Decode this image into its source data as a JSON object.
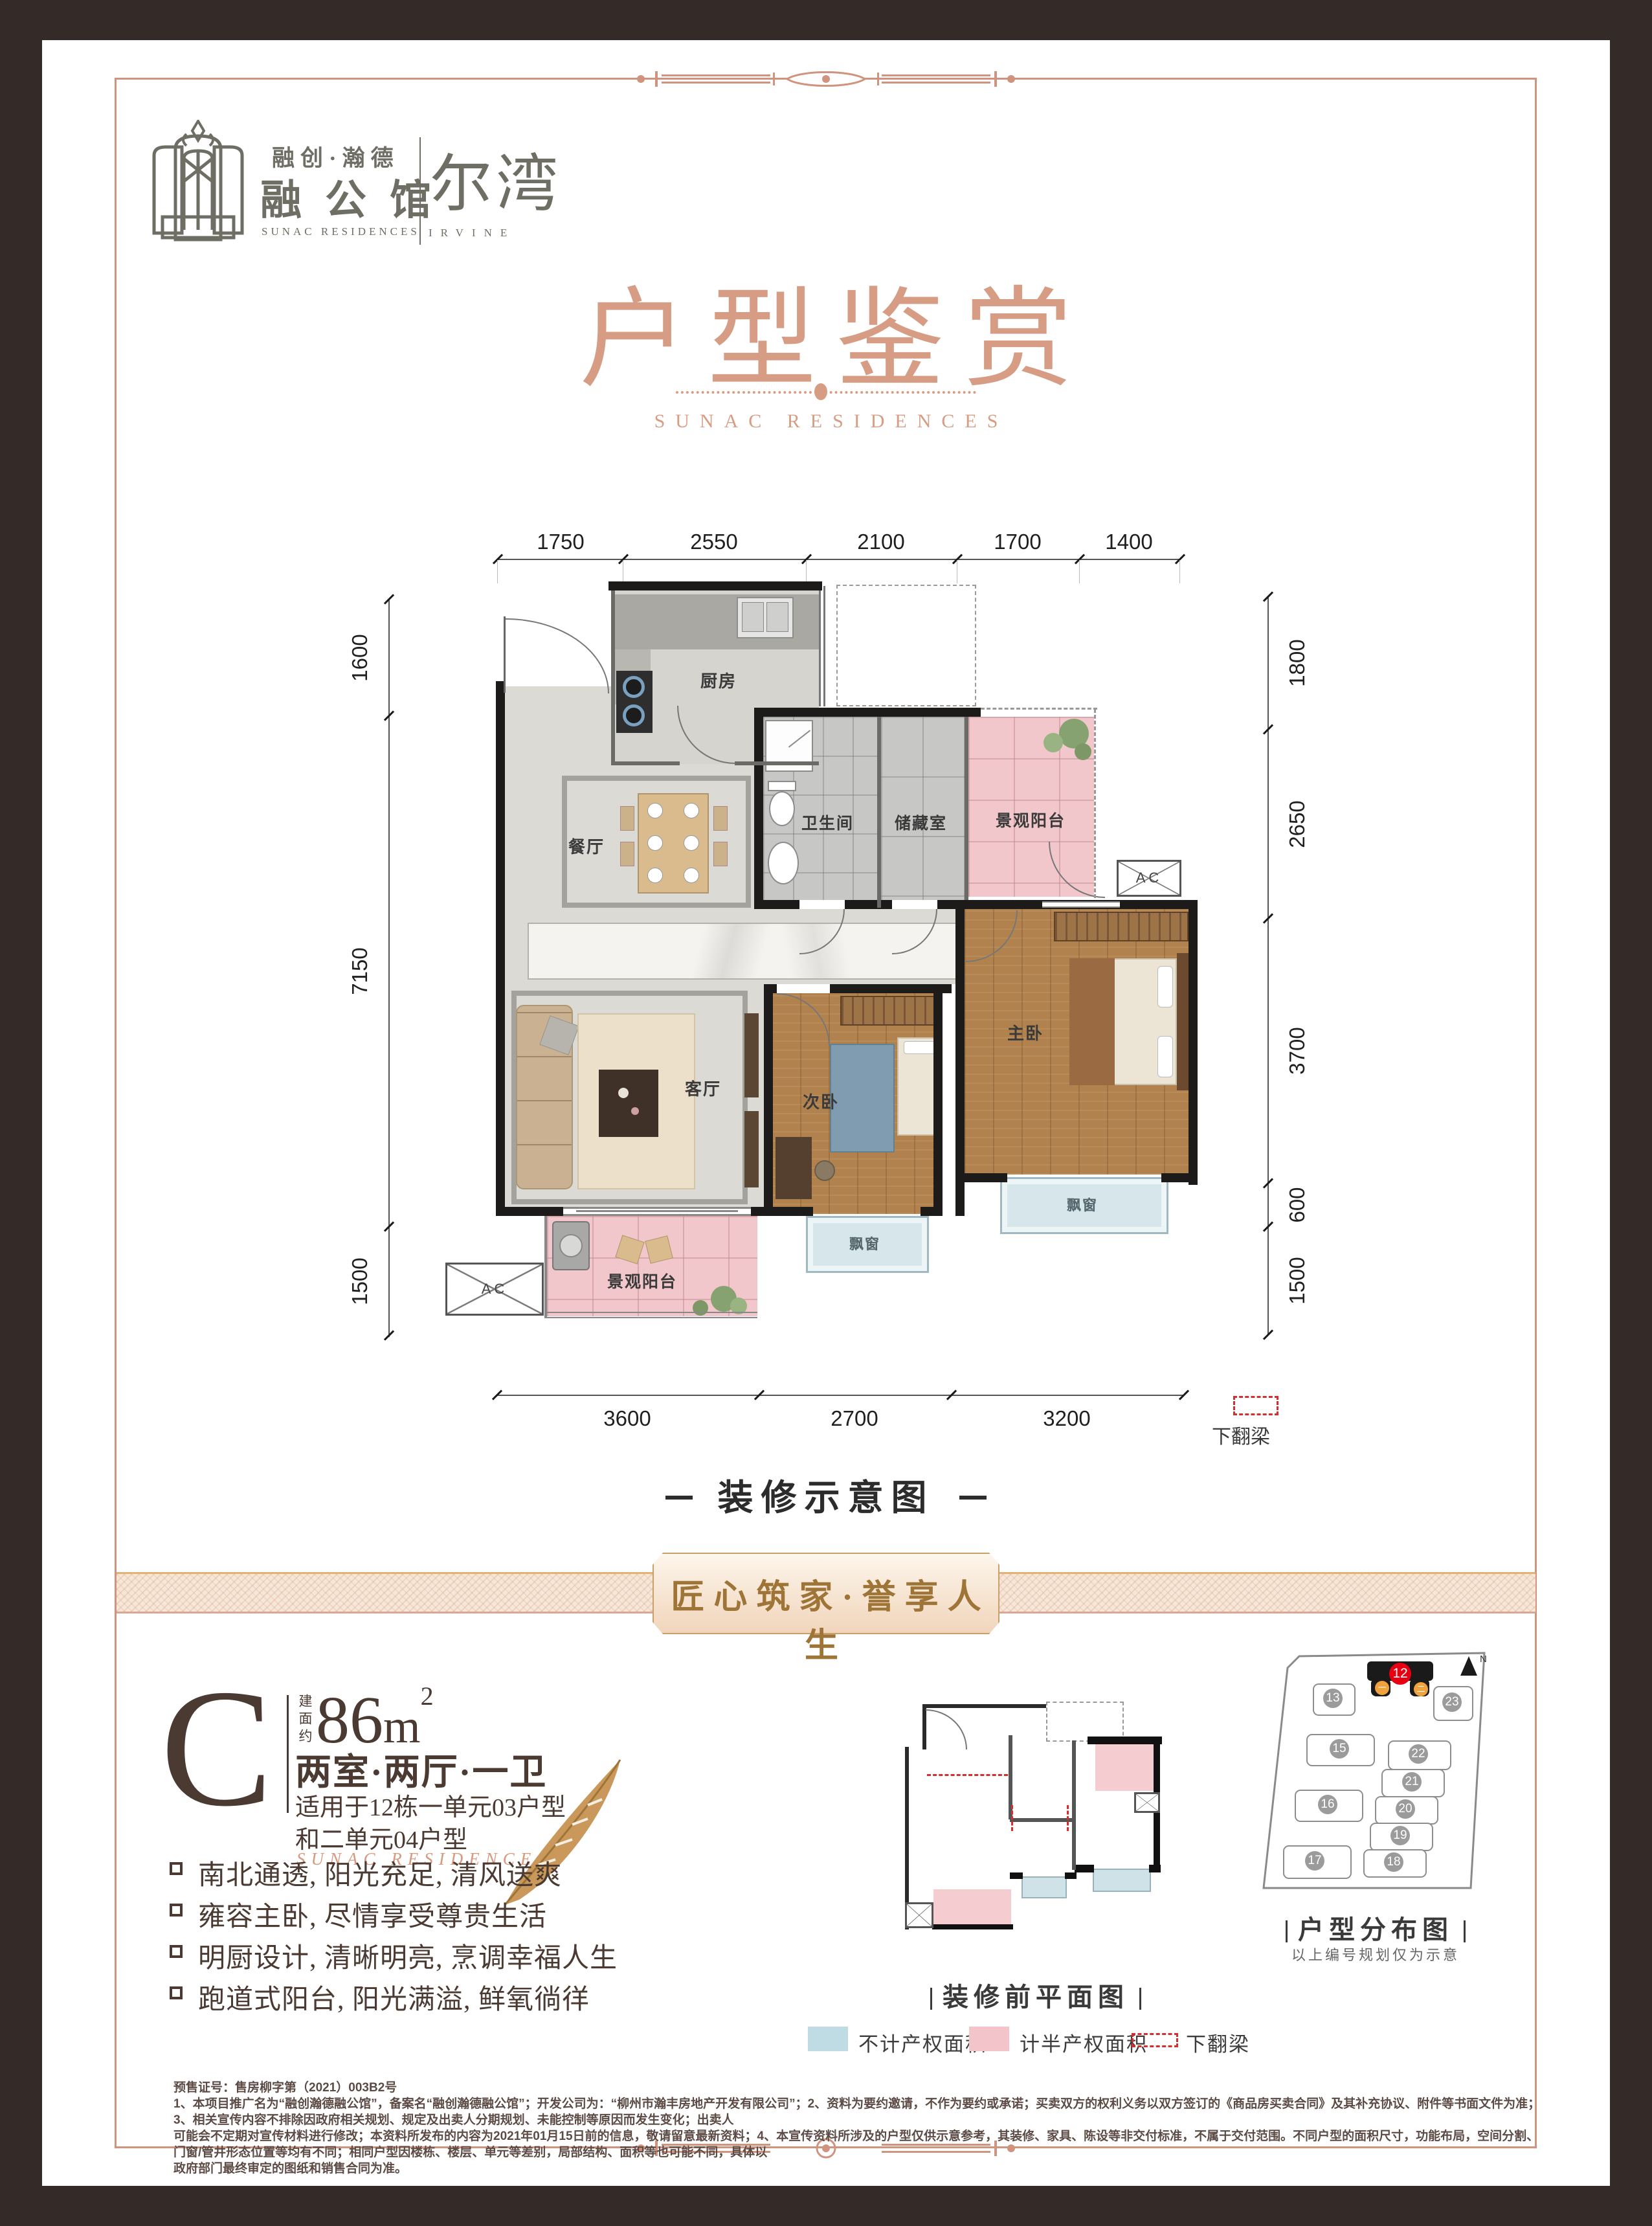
{
  "colors": {
    "accent_salmon": "#d0947e",
    "title_salmon": "#d79d84",
    "gold": "#a5793c",
    "dark_brown": "#4b3a32",
    "frame": "#342b28",
    "highlight_red": "#e60012",
    "legend_blue": "#bfdce4",
    "legend_pink": "#f3c4ca"
  },
  "logo": {
    "brand_cn": "融创·瀚德",
    "name_cn": "融公馆",
    "name_en": "SUNAC RESIDENCES",
    "sub_cn": "尔湾",
    "sub_en": "IRVINE"
  },
  "header": {
    "title": "户型鉴赏",
    "subtitle": "SUNAC RESIDENCES"
  },
  "floorplan": {
    "caption": "装修示意图",
    "dims_top": [
      "1750",
      "2550",
      "2100",
      "1700",
      "1400"
    ],
    "dims_bottom": [
      "3600",
      "2700",
      "3200"
    ],
    "dims_left": [
      "1600",
      "7150",
      "1500"
    ],
    "dims_right": [
      "1800",
      "2650",
      "3700",
      "600",
      "1500"
    ],
    "beam_note": "下翻梁",
    "rooms": {
      "kitchen": "厨房",
      "dining": "餐厅",
      "living": "客厅",
      "bath": "卫生间",
      "storage": "储藏室",
      "balcony": "景观阳台",
      "master": "主卧",
      "second": "次卧",
      "bay": "飘窗",
      "ac": "AC"
    }
  },
  "banner": {
    "text": "匠心筑家·誉享人生"
  },
  "unit": {
    "letter": "C",
    "area_label": "建面约",
    "area_value": "86",
    "area_unit": "m",
    "area_sup": "2",
    "layout": "两室·两厅·一卫",
    "apply1": "适用于12栋一单元03户型",
    "apply2": "和二单元04户型",
    "brand_en": "SUNAC RESIDENCES",
    "features": [
      "南北通透, 阳光充足, 清风送爽",
      "雍容主卧, 尽情享受尊贵生活",
      "明厨设计, 清晰明亮, 烹调幸福人生",
      "跑道式阳台, 阳光满溢, 鲜氧徜徉"
    ]
  },
  "preplan": {
    "caption": "装修前平面图",
    "legend_blue": "不计产权面积",
    "legend_pink": "计半产权面积",
    "legend_beam": "下翻梁"
  },
  "siteplan": {
    "caption": "户型分布图",
    "note": "以上编号规划仅为示意",
    "north": "N",
    "highlight": "12",
    "units": [
      "一",
      "二"
    ],
    "buildings": [
      "13",
      "23",
      "15",
      "22",
      "21",
      "16",
      "20",
      "19",
      "17",
      "18"
    ]
  },
  "disclaimer": {
    "line1": "预售证号：售房柳字第（2021）003B2号",
    "line2": "1、本项目推广名为“融创瀚德融公馆”，备案名“融创瀚德融公馆”；开发公司为：“柳州市瀚丰房地产开发有限公司”；2、资料为要约邀请，不作为要约或承诺；买卖双方的权利义务以双方签订的《商品房买卖合同》及其补充协议、附件等书面文件为准；3、相关宣传内容不排除因政府相关规划、规定及出卖人分期规划、未能控制等原因而发生变化；出卖人",
    "line3": "可能会不定期对宣传材料进行修改；本资料所发布的内容为2021年01月15日前的信息，敬请留意最新资料；4、本宣传资料所涉及的户型仅供示意参考，其装修、家具、陈设等非交付标准，不属于交付范围。不同户型的面积尺寸，功能布局，空间分割、门窗/管井形态位置等均有不同；相同户型因楼栋、楼层、单元等差别，局部结构、面积等也可能不同，具体以",
    "line4": "政府部门最终审定的图纸和销售合同为准。"
  }
}
